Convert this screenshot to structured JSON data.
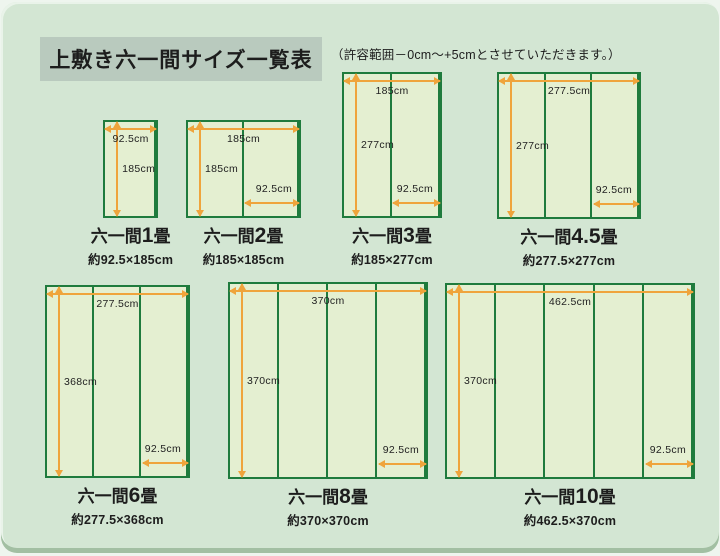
{
  "page": {
    "title": "上敷き六一間サイズ一覧表",
    "note": "（許容範囲－0cm～+5cmとさせていただきます。）"
  },
  "colors": {
    "background": "#d3e6d3",
    "title_box_bg": "#b9cabe",
    "mat_fill": "#e4efd1",
    "mat_border": "#1f7b3d",
    "arrow": "#efa43c",
    "text": "#1d1d1d"
  },
  "diagrams": [
    {
      "name_prefix": "六一間",
      "size_number": "1",
      "size_unit": "畳",
      "caption": "約92.5×185cm",
      "width_cm": 92.5,
      "height_cm": 185,
      "panels": 1,
      "top_label": "92.5cm",
      "side_label": "185cm",
      "panel_label": ""
    },
    {
      "name_prefix": "六一間",
      "size_number": "2",
      "size_unit": "畳",
      "caption": "約185×185cm",
      "width_cm": 185,
      "height_cm": 185,
      "panels": 2,
      "top_label": "185cm",
      "side_label": "185cm",
      "panel_label": "92.5cm"
    },
    {
      "name_prefix": "六一間",
      "size_number": "3",
      "size_unit": "畳",
      "caption": "約185×277cm",
      "width_cm": 185,
      "height_cm": 277,
      "panels": 2,
      "top_label": "185cm",
      "side_label": "277cm",
      "panel_label": "92.5cm"
    },
    {
      "name_prefix": "六一間",
      "size_number": "4.5",
      "size_unit": "畳",
      "caption": "約277.5×277cm",
      "width_cm": 277.5,
      "height_cm": 277,
      "panels": 3,
      "top_label": "277.5cm",
      "side_label": "277cm",
      "panel_label": "92.5cm"
    },
    {
      "name_prefix": "六一間",
      "size_number": "6",
      "size_unit": "畳",
      "caption": "約277.5×368cm",
      "width_cm": 277.5,
      "height_cm": 368,
      "panels": 3,
      "top_label": "277.5cm",
      "side_label": "368cm",
      "panel_label": "92.5cm"
    },
    {
      "name_prefix": "六一間",
      "size_number": "8",
      "size_unit": "畳",
      "caption": "約370×370cm",
      "width_cm": 370,
      "height_cm": 370,
      "panels": 4,
      "top_label": "370cm",
      "side_label": "370cm",
      "panel_label": "92.5cm"
    },
    {
      "name_prefix": "六一間",
      "size_number": "10",
      "size_unit": "畳",
      "caption": "約462.5×370cm",
      "width_cm": 462.5,
      "height_cm": 370,
      "panels": 5,
      "top_label": "462.5cm",
      "side_label": "370cm",
      "panel_label": "92.5cm"
    }
  ]
}
